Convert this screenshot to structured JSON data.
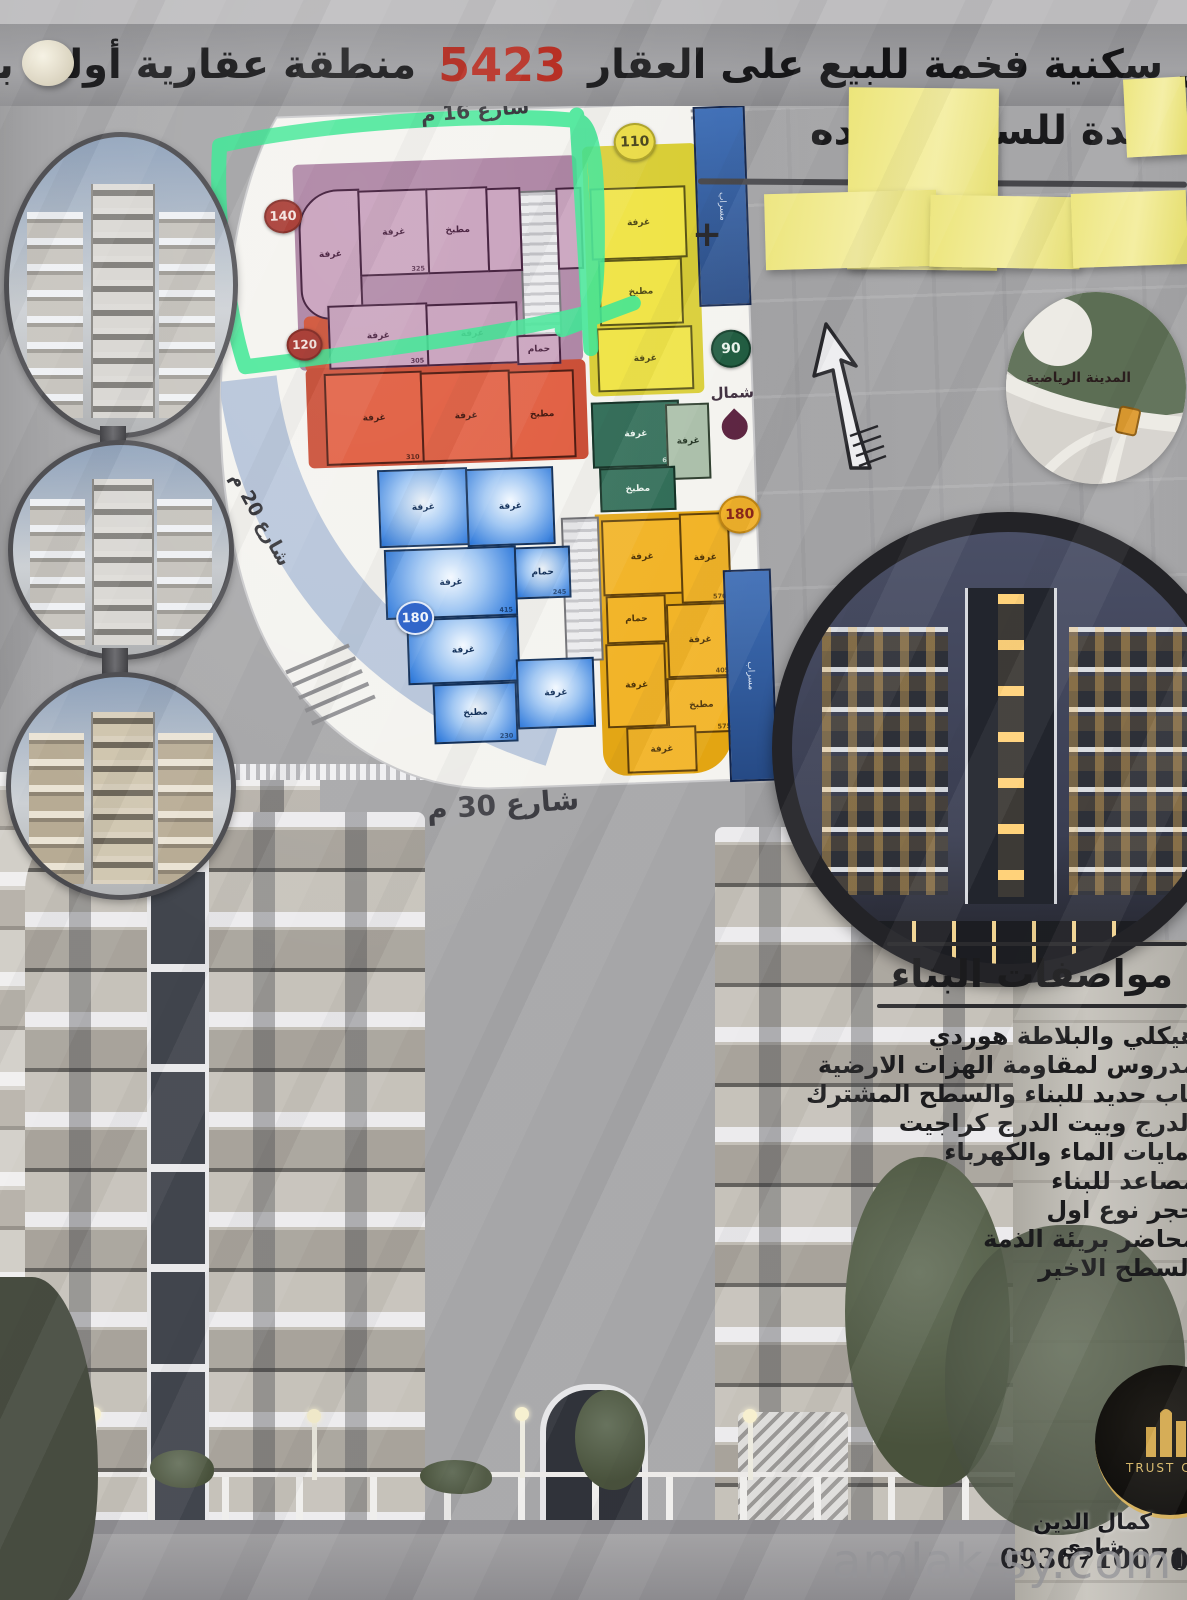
{
  "banner": {
    "title_pre": "شقق سكنية فخمة للبيع على العقار",
    "property_number": "5423",
    "title_post": "منطقة عقارية أولى بادلب"
  },
  "owner": {
    "prefix": "عائدة للسيد ع",
    "suffix": "وأولاده",
    "phone_hint": "+"
  },
  "plan": {
    "streets": {
      "top": "شارع 16 م",
      "left": "شارع 20 م",
      "bottom": "شارع 30 م"
    },
    "north_label": "شمال",
    "labels": {
      "room": "غرفة",
      "kitchen": "مطبخ",
      "bath": "حمام",
      "shaft": "مسراب"
    },
    "badges": {
      "purple": "140",
      "red": "120",
      "blue": "180",
      "yellow": "110",
      "green": "90",
      "orange": "180"
    },
    "areas": [
      "325",
      "305",
      "415",
      "245",
      "570",
      "405",
      "575",
      "310",
      "635",
      "230"
    ]
  },
  "map": {
    "area_label": "المدينة الرياضية"
  },
  "specs": {
    "title": "مواصفات البناء",
    "items": [
      "هيكلي والبلاطة هوردي",
      "مدروس لمقاومة الهزات الارضية",
      "باب حديد للبناء والسطح المشترك",
      "الدرج وبيت الدرج كراجيت",
      "امايات الماء والكهرباء",
      "مصاعد للبناء",
      "حجر نوع اول",
      "محاضر بريئة الذمة",
      "السطح الاخير"
    ]
  },
  "contact": {
    "logo_text": "TRUST CON",
    "agent_name": "كمال الدين شاوي",
    "phone": "0936710071",
    "phone_partial": "09"
  },
  "watermark": "amlak-sy.com"
}
